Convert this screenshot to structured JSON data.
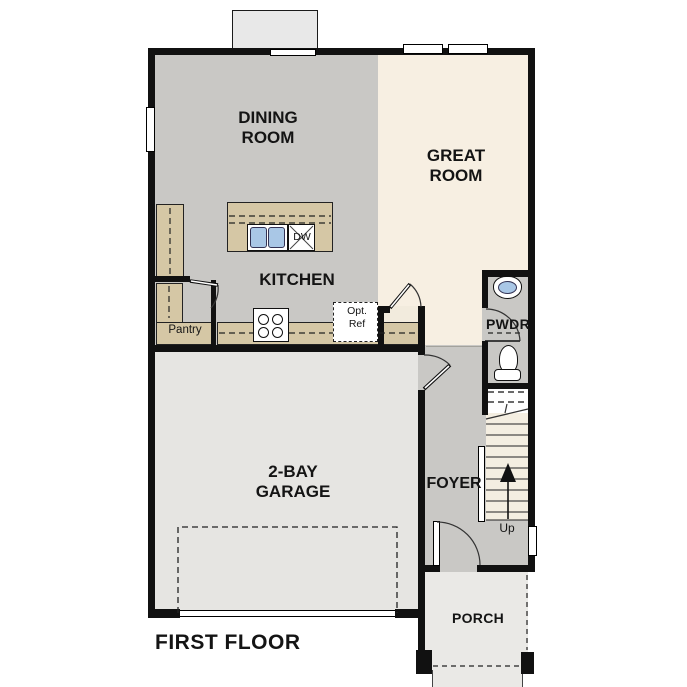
{
  "plan": {
    "title": "FIRST FLOOR"
  },
  "rooms": {
    "dining": {
      "line1": "DINING",
      "line2": "ROOM"
    },
    "great": {
      "line1": "GREAT",
      "line2": "ROOM"
    },
    "kitchen": {
      "label": "KITCHEN"
    },
    "garage": {
      "line1": "2-BAY",
      "line2": "GARAGE"
    },
    "foyer": {
      "label": "FOYER"
    },
    "pwdr": {
      "label": "PWDR"
    },
    "porch": {
      "label": "PORCH"
    },
    "pantry": {
      "label": "Pantry"
    }
  },
  "fixtures": {
    "dishwasher": {
      "label": "DW"
    },
    "opt_ref": {
      "line1": "Opt.",
      "line2": "Ref"
    },
    "stairs": {
      "up_label": "Up"
    }
  },
  "colors": {
    "wall": "#111111",
    "floor-gray": "#c9c8c5",
    "great-room-cream": "#f7efe2",
    "garage-gray": "#e6e5e2",
    "porch-gray": "#eae9e6",
    "counter-tan": "#d5c7a5",
    "sink-blue": "#a9c7e6",
    "stair-cream": "#f4eee1",
    "closet-cream": "#f2ebdd",
    "bumpout-gray": "#e8e8e8"
  }
}
